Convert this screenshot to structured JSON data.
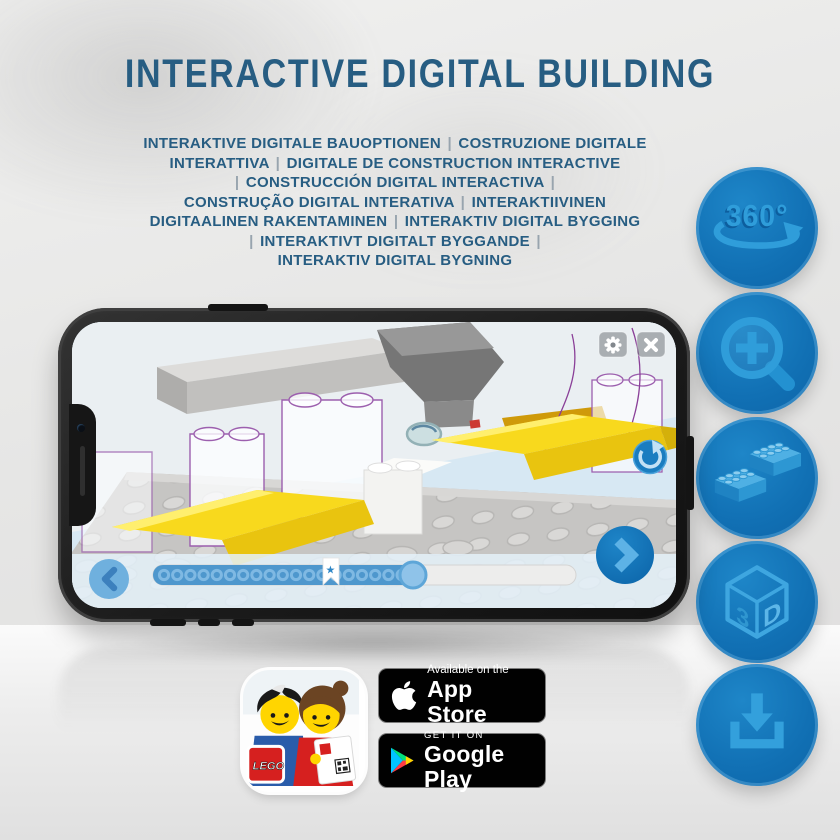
{
  "header": {
    "title": "INTERACTIVE DIGITAL BUILDING",
    "subtitle_lines": [
      "INTERAKTIVE DIGITALE BAUOPTIONEN | COSTRUZIONE DIGITALE",
      "INTERATTIVA | DIGITALE DE CONSTRUCTION INTERACTIVE",
      "| CONSTRUCCIÓN DIGITAL INTERACTIVA |",
      "CONSTRUÇÃO DIGITAL INTERATIVA | INTERAKTIIVINEN",
      "DIGITAALINEN RAKENTAMINEN | INTERAKTIV DIGITAL BYGGING",
      "| INTERAKTIVT DIGITALT BYGGANDE |",
      "INTERAKTIV DIGITAL BYGNING"
    ]
  },
  "side_icons": {
    "rotation_label": "360°",
    "cube_left": "3",
    "cube_right": "D"
  },
  "phone_screen": {
    "progress": {
      "dot_count": 19,
      "star_char": "★"
    }
  },
  "store_badges": {
    "app_store": {
      "tagline": "Available on the",
      "name": "App Store"
    },
    "google_play": {
      "tagline": "GET IT ON",
      "name": "Google Play"
    }
  },
  "app_icon": {
    "logo_text": "LEGO"
  },
  "colors": {
    "title_blue": "#275d82",
    "circle_blue": "#1170b4",
    "glyph_blue": "#2f9dda",
    "lego_yellow": "#f8d91d",
    "screen_bg": "#d7e8f3"
  }
}
